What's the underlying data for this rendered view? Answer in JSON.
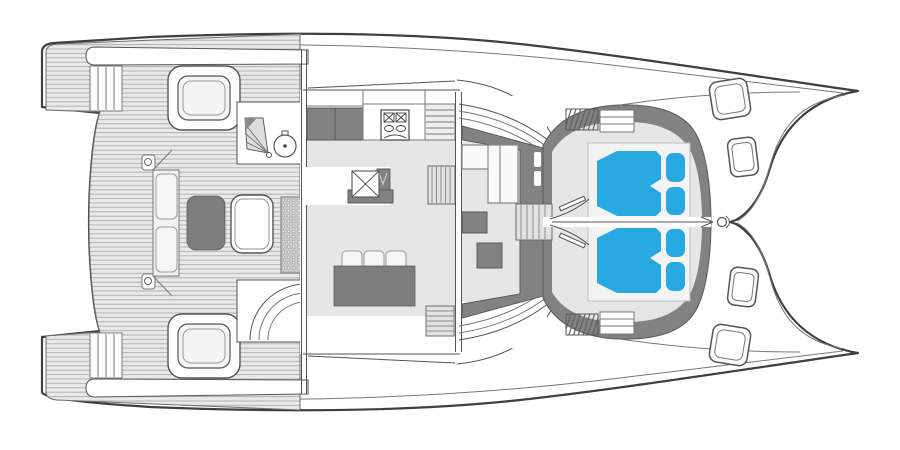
{
  "diagram": {
    "type": "yacht-deck-floorplan",
    "subject": "catamaran-main-deck-top-view",
    "orientation": "bow-right",
    "hulls": 2,
    "visible_text": []
  },
  "colors": {
    "outline": "#3f3f3f",
    "rubrail": "#777777",
    "line_mid": "#555555",
    "deck_base": "#e9e9e9",
    "plank_line": "#b2b2b2",
    "floor": "#e6e6e6",
    "furniture_dark": "#7d7d7d",
    "wall_dark": "#828282",
    "cushion": "#f6f6f6",
    "bed_blue": "#29a9e1",
    "stair_fill": "#e2e2e2",
    "grate_base": "#c9c9c9",
    "white": "#ffffff"
  }
}
